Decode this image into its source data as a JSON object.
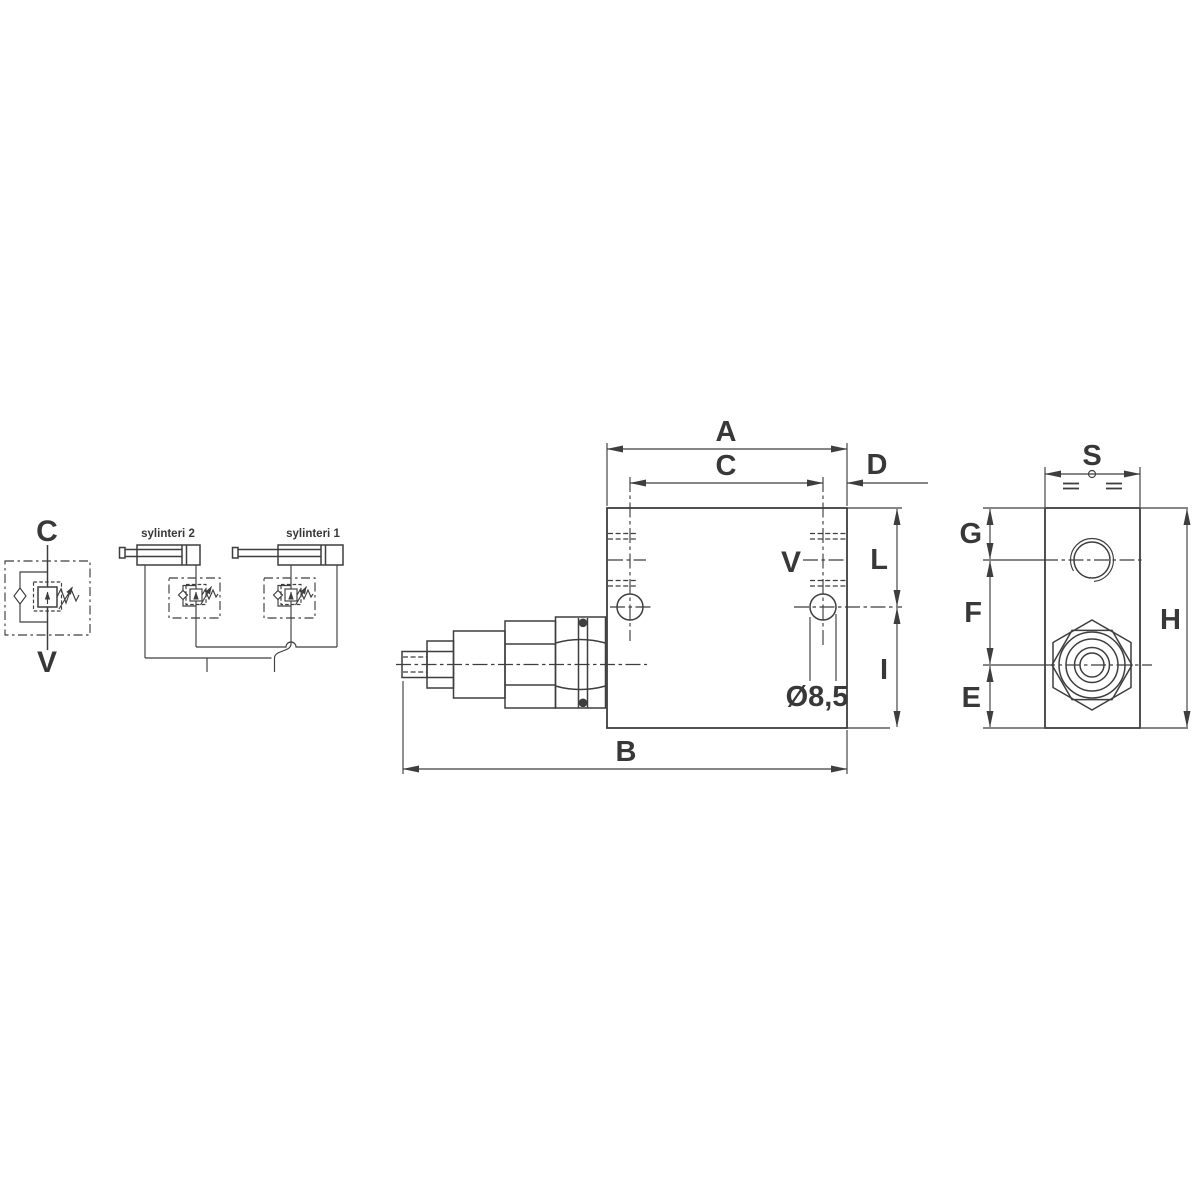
{
  "colors": {
    "line": "#3e3e3e",
    "accent_red": "#d8201d",
    "background": "#ffffff"
  },
  "valve_symbol": {
    "port_top_label": "C",
    "port_bottom_label": "V"
  },
  "application_schematic": {
    "cylinder_2_label": "sylinteri 2",
    "cylinder_1_label": "sylinteri 1"
  },
  "side_view": {
    "dim_overall_top": "A",
    "dim_hole_spacing": "C",
    "dim_hole_to_edge": "D",
    "dim_overall_length": "B",
    "dim_top_to_holes": "L",
    "dim_holes_to_bottom": "I",
    "port_label": "V",
    "hole_diameter_label": "Ø8,5"
  },
  "end_view": {
    "dim_width": "S",
    "dim_top_to_port": "G",
    "dim_port_to_axis": "F",
    "dim_axis_to_bottom": "E",
    "dim_height": "H"
  }
}
